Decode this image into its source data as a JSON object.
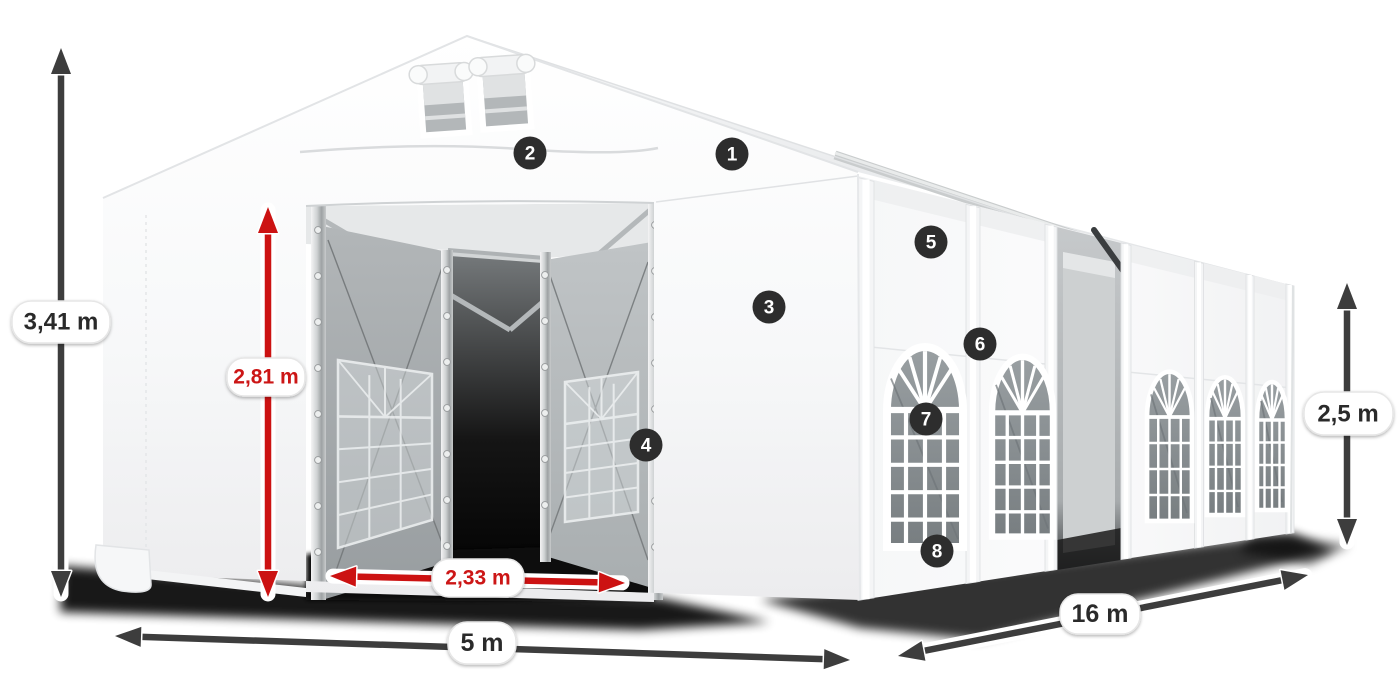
{
  "diagram": {
    "subject": "tent-dimension-diagram",
    "background": "#ffffff",
    "accent_red": "#cc1212",
    "arrow_color": "#3d3d3d",
    "badge_color": "#2d2d2d",
    "label_text_color": "#2c2c2c",
    "pill_border": "#e6e6e6"
  },
  "dimensions": {
    "total_height": "3,41 m",
    "entrance_height": "2,81 m",
    "entrance_width": "2,33 m",
    "front_width": "5 m",
    "length": "16 m",
    "side_height": "2,5 m"
  },
  "badges": [
    {
      "number": "1"
    },
    {
      "number": "2"
    },
    {
      "number": "3"
    },
    {
      "number": "4"
    },
    {
      "number": "5"
    },
    {
      "number": "6"
    },
    {
      "number": "7"
    },
    {
      "number": "8"
    }
  ]
}
